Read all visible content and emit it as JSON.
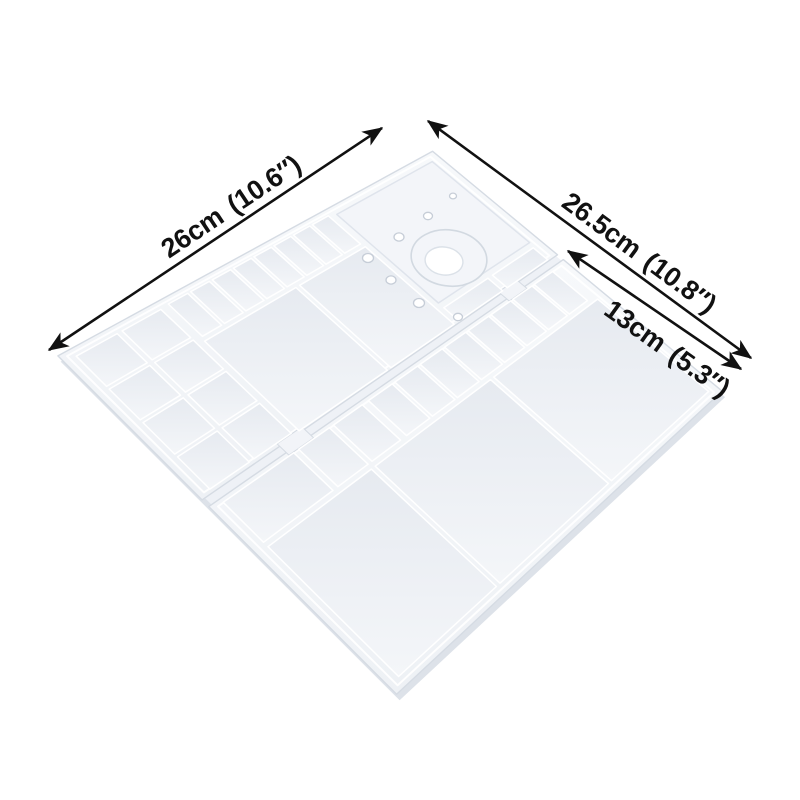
{
  "colors": {
    "background": "#ffffff",
    "ink": "#111111",
    "surface_light": "#f7f9fb",
    "surface_dark": "#eef1f5",
    "well_dark": "#e6eaf0",
    "well_light": "#f4f6f9",
    "outline": "#d5dbe3",
    "ridge_highlight": "#ffffff",
    "side_shadow": "#dde2e9",
    "plateau": "#f3f5f9",
    "plateau_edge": "#dfe4ec",
    "hole_rim": "#c6cdd7",
    "seam": "#eef1f6",
    "latch": "#f2f4f8"
  },
  "dimensions": [
    {
      "id": "palette-length",
      "value": "26cm",
      "inches": "(10.6″)"
    },
    {
      "id": "palette-width",
      "value": "26.5cm",
      "inches": "(10.8″)"
    },
    {
      "id": "panel-width",
      "value": "13cm",
      "inches": "(5.3″)"
    }
  ]
}
